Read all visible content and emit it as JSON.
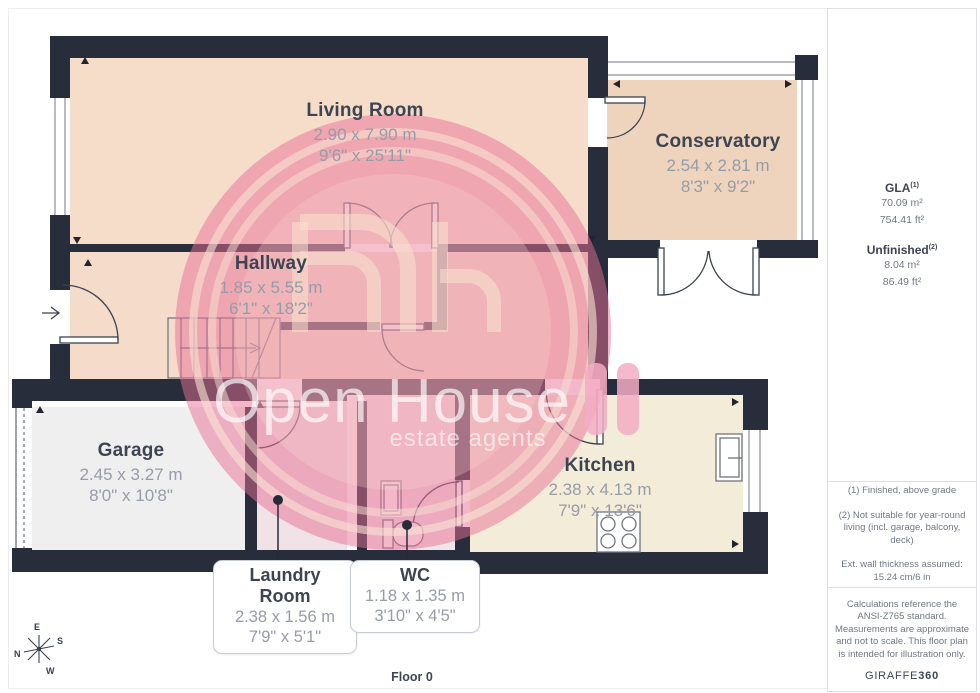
{
  "watermark": {
    "title": "Open House",
    "subtitle": "estate agents"
  },
  "rooms": [
    {
      "id": "living-room",
      "name": "Living Room",
      "metric": "2.90 x 7.90 m",
      "imperial": "9'6\" x 25'11\""
    },
    {
      "id": "conservatory",
      "name": "Conservatory",
      "metric": "2.54 x 2.81 m",
      "imperial": "8'3\" x 9'2\""
    },
    {
      "id": "hallway",
      "name": "Hallway",
      "metric": "1.85 x 5.55 m",
      "imperial": "6'1\" x 18'2\""
    },
    {
      "id": "garage",
      "name": "Garage",
      "metric": "2.45 x 3.27 m",
      "imperial": "8'0\" x 10'8\""
    },
    {
      "id": "kitchen",
      "name": "Kitchen",
      "metric": "2.38 x 4.13 m",
      "imperial": "7'9\" x 13'6\""
    },
    {
      "id": "laundry-room",
      "name": "Laundry Room",
      "metric": "2.38 x 1.56 m",
      "imperial": "7'9\" x 5'1\""
    },
    {
      "id": "wc",
      "name": "WC",
      "metric": "1.18 x 1.35 m",
      "imperial": "3'10\" x 4'5\""
    }
  ],
  "sidebar": {
    "gla_label": "GLA",
    "gla_sup": "(1)",
    "gla_m2": "70.09 m²",
    "gla_ft2": "754.41 ft²",
    "unfinished_label": "Unfinished",
    "unfinished_sup": "(2)",
    "unfinished_m2": "8.04 m²",
    "unfinished_ft2": "86.49 ft²",
    "footnote1": "(1) Finished, above grade",
    "footnote2": "(2) Not suitable for year-round living (incl. garage, balcony, deck)",
    "footnote3": "Ext. wall thickness assumed: 15.24 cm/6 in",
    "disclaimer": "Calculations reference the ANSI-Z765 standard. Measurements are approximate and not to scale. This floor plan is intended for illustration only.",
    "brand_name": "GIRAFFE",
    "brand_suffix": "360"
  },
  "floor_label": "Floor 0",
  "compass": {
    "n": "N",
    "e": "E",
    "s": "S",
    "w": "W"
  },
  "colors": {
    "wall": "#272d3b",
    "accent_pink": "#e76f96",
    "room_cream": "#f6ddca",
    "kitchen_cream": "#f2ecd8"
  }
}
